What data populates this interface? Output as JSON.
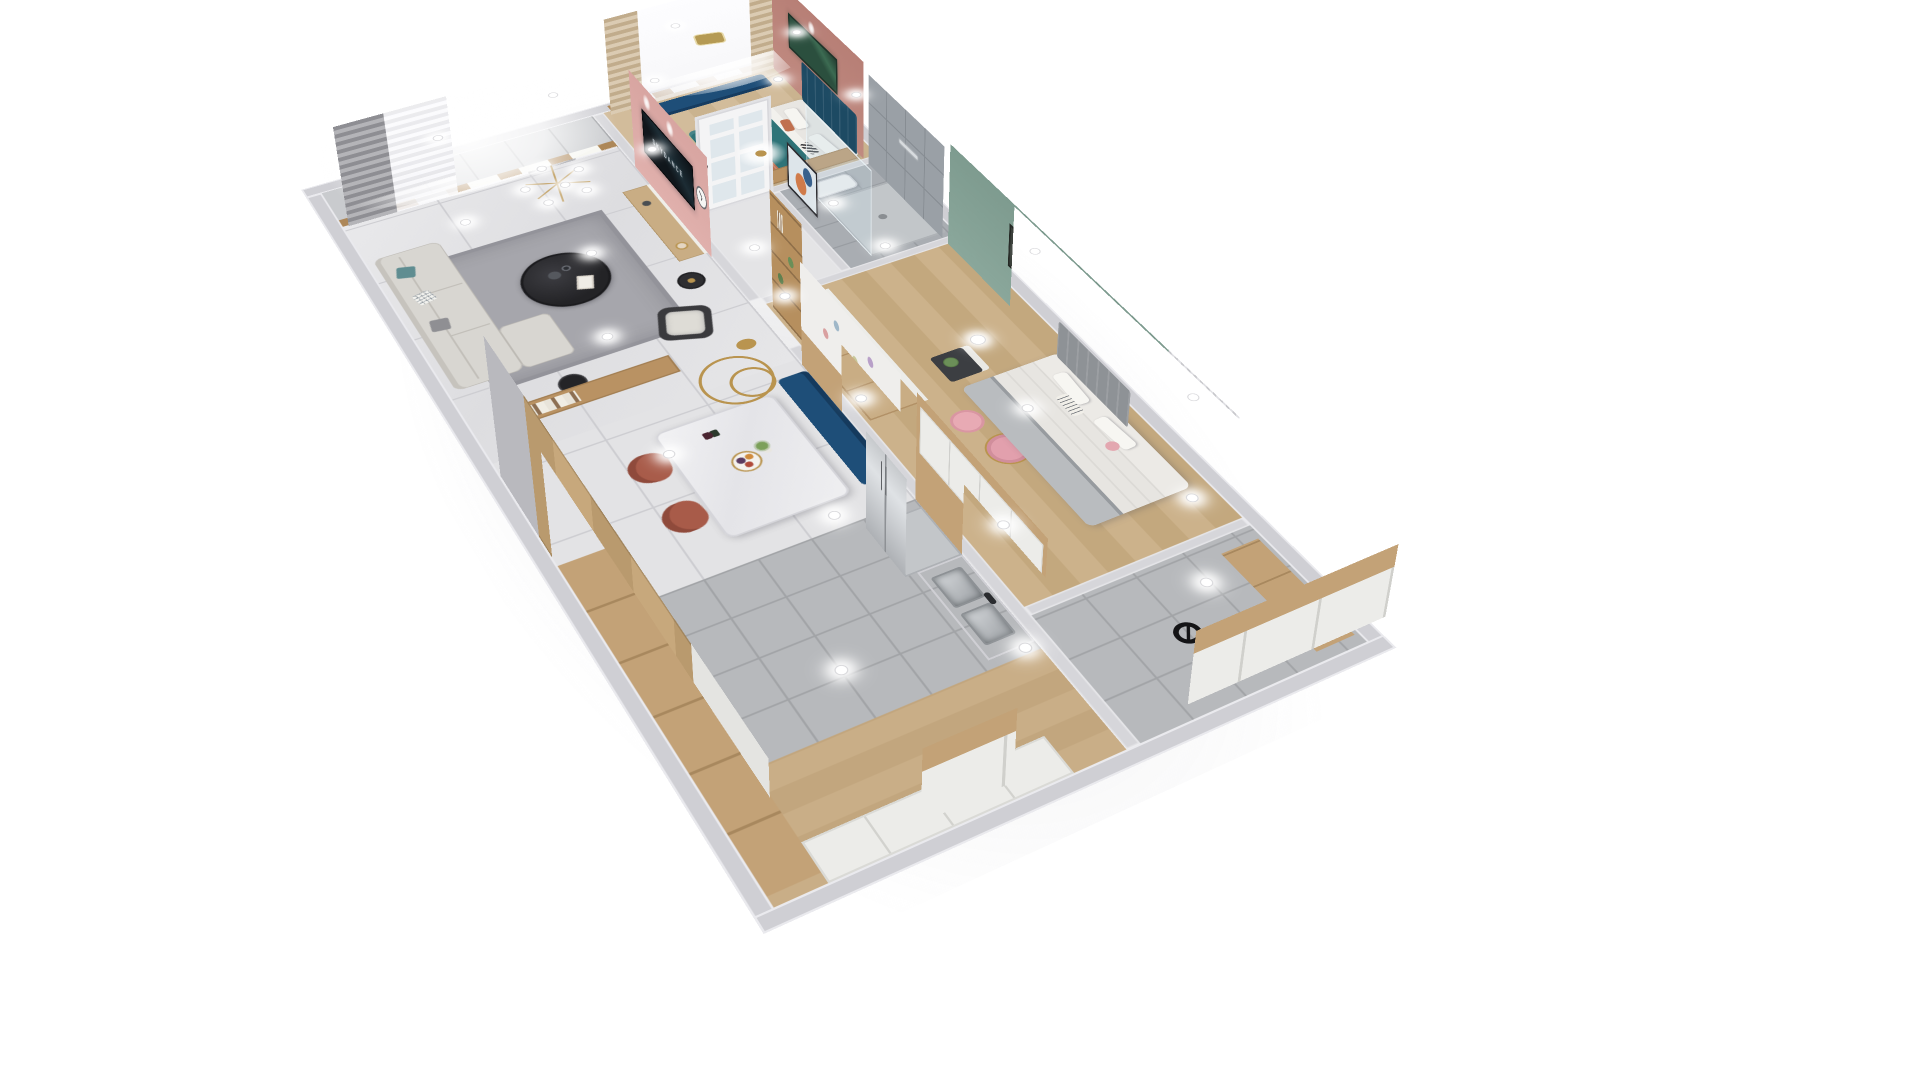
{
  "scene": {
    "title": "3D isometric cutaway render of a two-bedroom apartment",
    "view": "dollhouse top-down perspective on white background",
    "background": "#ffffff"
  },
  "tv": {
    "screen_text": "SKYDANCE"
  },
  "colors": {
    "wallTop": "#cfcfd4",
    "spine": "#d6d6da",
    "marble": "#e3e3e5",
    "grayTile": "#b7b9bc",
    "bathTile": "#a9adb2",
    "woodFloor": "#cdb794",
    "woodFloor2": "#c8ad85",
    "woodCab": "#c3a277",
    "woodTop": "#c9ad84",
    "consoleWood": "#b99263",
    "pinkWall": "#e0b0ac",
    "pinkDeep": "#c08a80",
    "greenWall": "#8aa79b",
    "artGreen": "#2b4f3e",
    "teal": "#2f7478",
    "headboardNavy": "#1d4a63",
    "navy": "#1e4e78",
    "rust": "#a85b49",
    "terracotta": "#bc6f52",
    "sofa": "#d8d6d1",
    "rug": "#a6a6ac",
    "tableBlack": "#232326",
    "gold": "#b9944f",
    "steel": "#c0c3c7",
    "curtainGray": "#97979c",
    "curtainBeige": "#cdb795",
    "cabinetWhite": "#ecece9"
  },
  "rooms": [
    {
      "name": "balcony",
      "items": [
        "tiled floor",
        "wood framed windows",
        "daylight glow"
      ]
    },
    {
      "name": "living-room",
      "items": [
        "gray modular sofa with chaise",
        "round black coffee table",
        "armchair",
        "black side table",
        "floor lamp",
        "wood console with books",
        "gray rug",
        "sheer and gray curtains with gold tieback",
        "brass globe chandelier",
        "pink tv wall",
        "wall mounted tv",
        "tv console",
        "wall clock"
      ]
    },
    {
      "name": "master-bedroom",
      "items": [
        "double bed with teal blanket",
        "navy tufted headboard",
        "terracotta pillows",
        "white nightstand",
        "navy window bench",
        "beige curtains",
        "pendant light",
        "green wall art",
        "wood desk",
        "hanging gold tray"
      ]
    },
    {
      "name": "bathroom",
      "items": [
        "gray tile walls",
        "glass shower enclosure",
        "wall water heater"
      ]
    },
    {
      "name": "hallway",
      "items": [
        "white glass-paneled door",
        "flower ceiling lamp",
        "framed wall art"
      ]
    },
    {
      "name": "second-bedroom",
      "items": [
        "bed with white and gray bedding",
        "gray headboard",
        "white wardrobe with wood top",
        "corner display shelves with plants",
        "dark nightstand",
        "pink vanity stool",
        "pink chair",
        "table lamp",
        "sage green accent wall",
        "framed art",
        "window curtains"
      ]
    },
    {
      "name": "dining-room",
      "items": [
        "white marble dining table",
        "two rust leather chairs",
        "navy upholstered bench",
        "decal wall",
        "brass ring pendant",
        "fruit platter",
        "flower vase"
      ]
    },
    {
      "name": "kitchen",
      "items": [
        "stainless double-door fridge",
        "white cabinets",
        "double stainless sink",
        "black faucet",
        "wood feature wall"
      ]
    },
    {
      "name": "entry",
      "items": [
        "wood floor",
        "full-height wood wardrobes",
        "white shoe cabinets",
        "round black decor"
      ]
    }
  ]
}
